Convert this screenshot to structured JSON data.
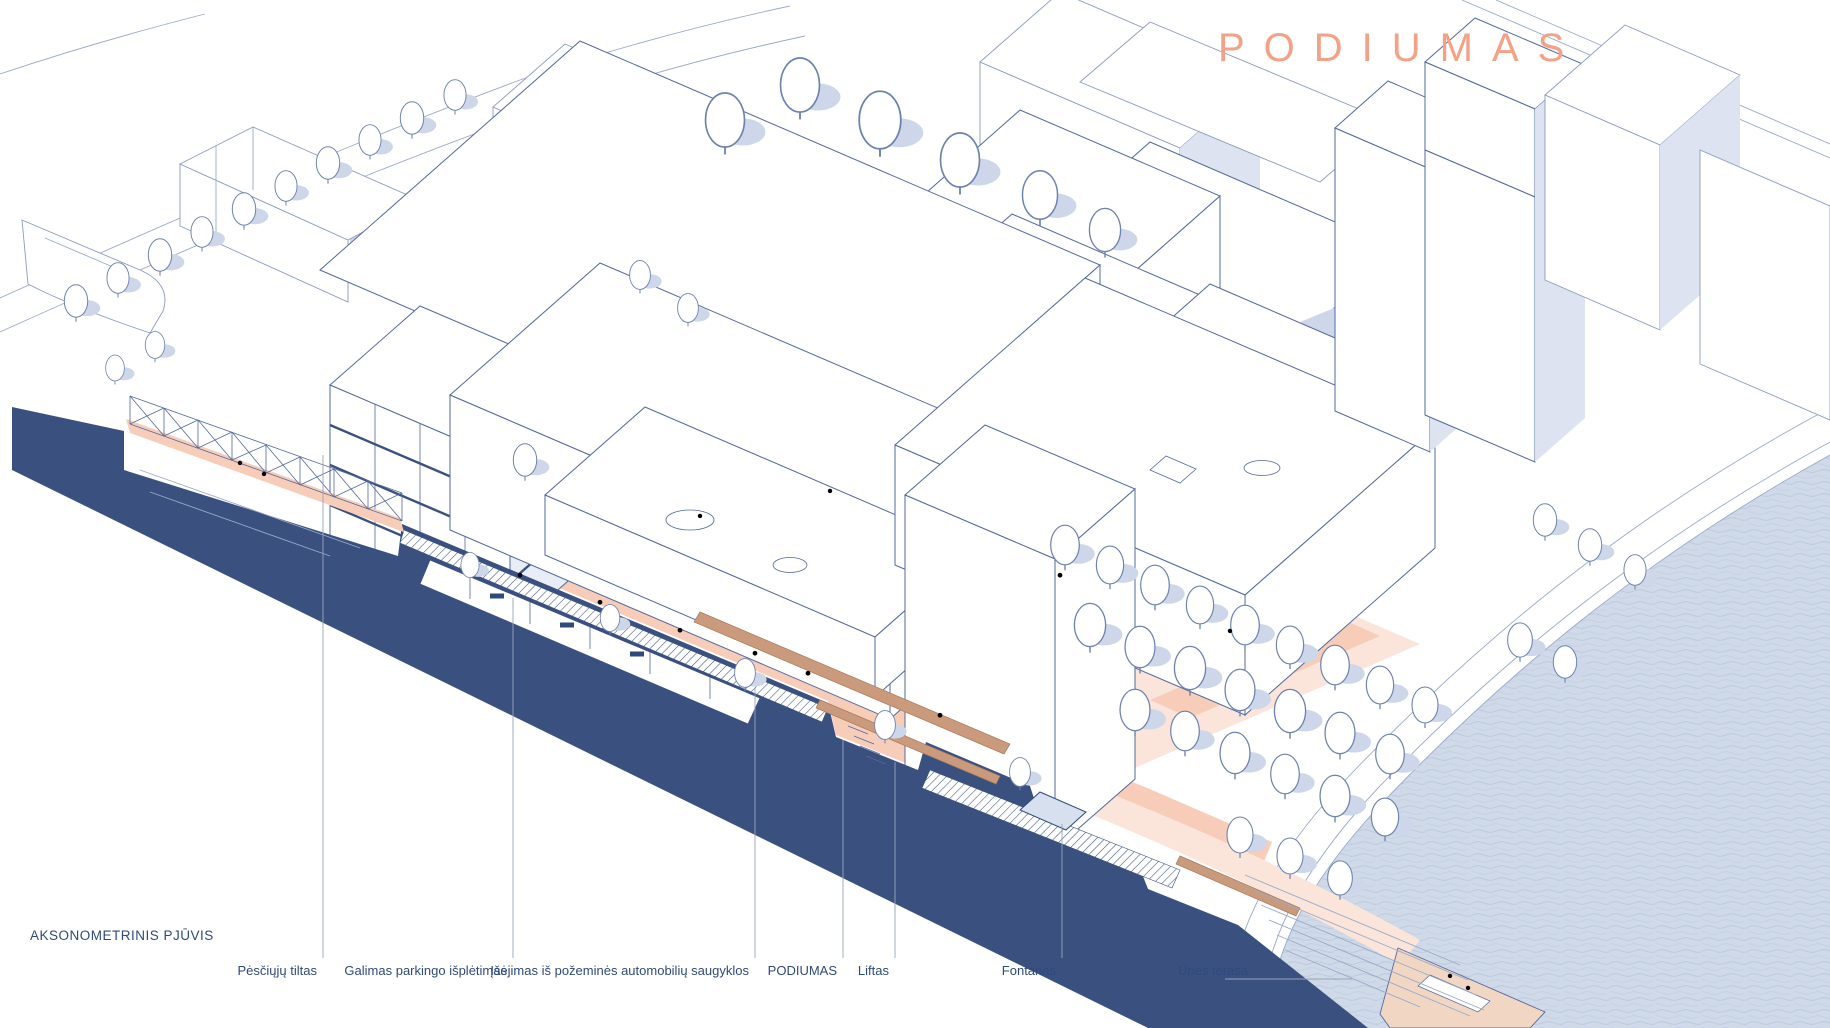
{
  "title": {
    "text": "PODIUMAS"
  },
  "caption": {
    "text": "AKSONOMETRINIS PJŪVIS"
  },
  "legend_labels": [
    {
      "id": "pedestrian-bridge",
      "text": "Pėsčiųjų tiltas"
    },
    {
      "id": "parking-extension",
      "text": "Galimas parkingo išplėtimas"
    },
    {
      "id": "garage-entrance",
      "text": "Įšėjimas iš požeminės automobilių saugyklos"
    },
    {
      "id": "podiumas",
      "text": "PODIUMAS"
    },
    {
      "id": "lift",
      "text": "Liftas"
    },
    {
      "id": "fountain",
      "text": "Fontanas"
    },
    {
      "id": "river-terrace",
      "text": "Upės terasa"
    }
  ],
  "colors": {
    "title_salmon": "#f2a287",
    "line_blue": "#53699c",
    "section_navy": "#3a5180",
    "plaza_salmon": "#f7cdb9",
    "shadow_blue": "#cdd7e9",
    "river_blue": "#cfd9e8",
    "label_text": "#2e4a7a"
  }
}
